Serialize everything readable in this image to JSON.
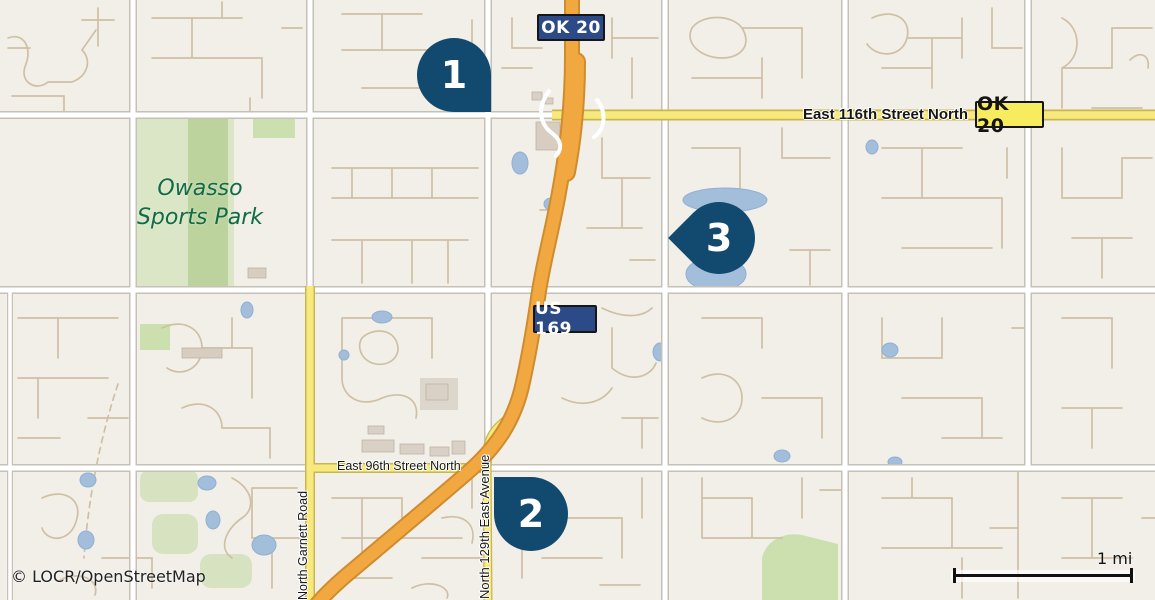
{
  "map": {
    "type": "road-map",
    "attribution": "© LOCR/OpenStreetMap",
    "scale": {
      "label": "1 mi"
    },
    "park": {
      "line1": "Owasso",
      "line2": "Sports Park"
    },
    "streets": {
      "e116": "East 116th Street North",
      "e96": "East 96th Street North",
      "garnett": "North Garnett Road",
      "n129": "North 129th East Avenue"
    },
    "shields": {
      "ok20_top": "OK 20",
      "ok20_right": "OK 20",
      "us169": "US 169"
    },
    "markers": [
      {
        "number": "1"
      },
      {
        "number": "2"
      },
      {
        "number": "3"
      }
    ],
    "colors": {
      "background": "#f2efe9",
      "highway_fill": "#f1a840",
      "highway_casing": "#d08c2c",
      "secondary_road_fill": "#f7e97e",
      "secondary_road_casing": "#c8b64e",
      "white_road": "#ffffff",
      "road_casing": "#c6c0b6",
      "minor_road": "#cfc0a4",
      "water": "#a3bedb",
      "park_green": "#bcd29c",
      "marker_fill": "#114a6e",
      "shield_navy": "#2c4a88",
      "shield_yellow": "#f7eb5e",
      "park_text_green": "#116b45"
    }
  }
}
